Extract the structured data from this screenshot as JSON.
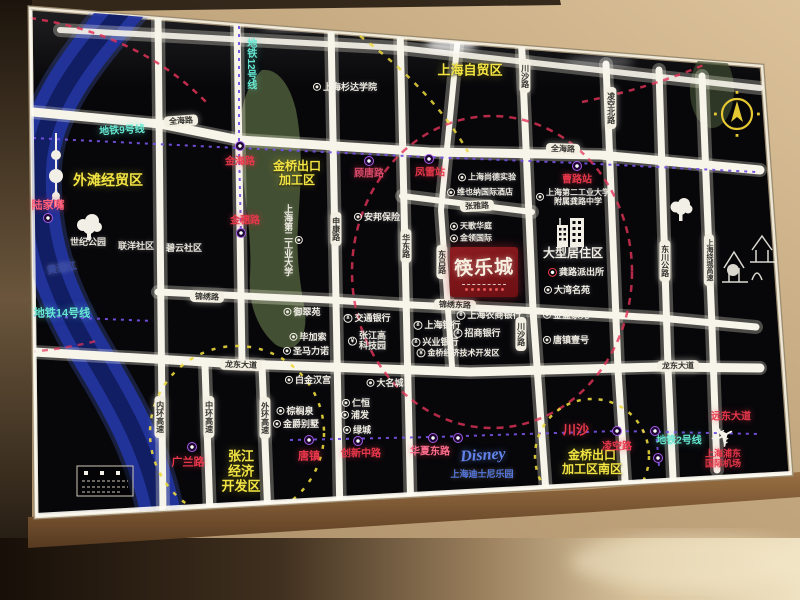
{
  "palette": {
    "panel_black": "#07070a",
    "road_white": "#f7f4ea",
    "river_blue": "#2238a8",
    "metro_dash_purple": "#7450e0",
    "metro_teal": "#66e8d2",
    "area_yellow": "#f2e443",
    "station_red": "#e8374a",
    "poi_white": "#efece2",
    "disney_blue": "#6383ea",
    "logo_red": "#7a161a",
    "green_zone": "#4e5c39",
    "wall_beige": "#c2a67e",
    "wood_brown": "#8a6038",
    "compass_yellow": "#e5c832"
  },
  "icons": {
    "airplane": "✈",
    "metro": "circle-M-badge",
    "poi": "ring-dot",
    "bank": "¥",
    "police": "red-ring-dot",
    "compass": "north-arrow",
    "tree": "tree-silhouette",
    "tower": "pearl-tower-silhouette",
    "temple": "old-town-lineart",
    "building": "residential-towers"
  },
  "map": {
    "logo": {
      "name": "筷乐城"
    },
    "labels": [
      {
        "n": "label-metro-line-12",
        "t": "地铁12号线",
        "x": 250,
        "y": 64,
        "k": "metroline",
        "v": 1,
        "s": 10
      },
      {
        "n": "label-metro-line-9",
        "t": "地铁9号线",
        "x": 122,
        "y": 131,
        "k": "metroline",
        "s": 10,
        "r": -3
      },
      {
        "n": "label-metro-line-14",
        "t": "地铁14号线",
        "x": 62,
        "y": 314,
        "k": "metroline",
        "s": 11
      },
      {
        "n": "label-metro-line-2",
        "t": "地铁2号线",
        "x": 679,
        "y": 441,
        "k": "metroline",
        "s": 10
      },
      {
        "n": "pill-quanhai-road-w",
        "t": "全海路",
        "x": 181,
        "y": 121,
        "k": "pill",
        "r": -4
      },
      {
        "n": "pill-quanhai-road-e",
        "t": "全海路",
        "x": 563,
        "y": 149,
        "k": "pill",
        "r": 2
      },
      {
        "n": "pill-jinxiu-road",
        "t": "锦绣路",
        "x": 207,
        "y": 297,
        "k": "pill",
        "r": 2
      },
      {
        "n": "pill-jinxiu-east-road",
        "t": "锦绣东路",
        "x": 455,
        "y": 305,
        "k": "pill",
        "r": 2
      },
      {
        "n": "pill-longdong-ave-w",
        "t": "龙东大道",
        "x": 241,
        "y": 365,
        "k": "pill",
        "r": 2
      },
      {
        "n": "pill-longdong-ave-e",
        "t": "龙东大道",
        "x": 678,
        "y": 366,
        "k": "pill",
        "r": -1
      },
      {
        "n": "pill-chuansha-road-n",
        "t": "川沙路",
        "x": 525,
        "y": 76,
        "k": "pill",
        "v": 1
      },
      {
        "n": "pill-lingkong-north-road",
        "t": "凌空北路",
        "x": 611,
        "y": 108,
        "k": "pill",
        "v": 1
      },
      {
        "n": "pill-shenkang-road",
        "t": "申康路",
        "x": 336,
        "y": 229,
        "k": "pill",
        "v": 1
      },
      {
        "n": "pill-huadong-road",
        "t": "华东路",
        "x": 406,
        "y": 246,
        "k": "pill",
        "v": 1
      },
      {
        "n": "pill-donglv-road",
        "t": "东吕路",
        "x": 442,
        "y": 262,
        "k": "pill",
        "v": 1
      },
      {
        "n": "pill-chuansha-road-s",
        "t": "川沙路",
        "x": 521,
        "y": 334,
        "k": "pill",
        "v": 1
      },
      {
        "n": "pill-dongchuan-highway",
        "t": "东川公路",
        "x": 665,
        "y": 261,
        "k": "pill",
        "v": 1
      },
      {
        "n": "pill-raocheng-expressway",
        "t": "上海绕城高速",
        "x": 709,
        "y": 260,
        "k": "pill",
        "v": 1,
        "s": 7
      },
      {
        "n": "pill-zhangya-road",
        "t": "张雅路",
        "x": 477,
        "y": 206,
        "k": "pill",
        "r": -3
      },
      {
        "n": "pill-neihuan-expressway",
        "t": "内环高速",
        "x": 160,
        "y": 417,
        "k": "pill",
        "v": 1
      },
      {
        "n": "pill-zhonghuan-expressway",
        "t": "中环高速",
        "x": 209,
        "y": 417,
        "k": "pill",
        "v": 1
      },
      {
        "n": "pill-waihuan-expressway",
        "t": "外环高速",
        "x": 265,
        "y": 418,
        "k": "pill",
        "v": 1
      },
      {
        "n": "label-waitan-trade-zone",
        "t": "外滩经贸区",
        "x": 108,
        "y": 180,
        "k": "area",
        "s": 14
      },
      {
        "n": "label-jinqiao-epz",
        "t": "金桥出口\n加工区",
        "x": 297,
        "y": 174,
        "k": "area",
        "s": 12
      },
      {
        "n": "label-shanghai-ftz",
        "t": "上海自贸区",
        "x": 470,
        "y": 71,
        "k": "area",
        "s": 13
      },
      {
        "n": "label-zhangjiang-zone",
        "t": "张江\n经济\n开发区",
        "x": 241,
        "y": 472,
        "k": "area",
        "s": 13
      },
      {
        "n": "label-jinqiao-epz-south",
        "t": "金桥出口\n加工区南区",
        "x": 592,
        "y": 463,
        "k": "area",
        "s": 12
      },
      {
        "n": "label-lujiazui",
        "t": "陆家嘴",
        "x": 48,
        "y": 206,
        "k": "station",
        "s": 11,
        "c": "#ff5d78"
      },
      {
        "n": "label-jinhai-road",
        "t": "金海路",
        "x": 240,
        "y": 162,
        "k": "station",
        "s": 10
      },
      {
        "n": "label-jinsui-road",
        "t": "金穗路",
        "x": 245,
        "y": 221,
        "k": "station",
        "s": 10
      },
      {
        "n": "label-gutang-road",
        "t": "顾唐路",
        "x": 369,
        "y": 174,
        "k": "station",
        "s": 10,
        "c": "#d84a6a"
      },
      {
        "n": "label-fenglei-station",
        "t": "凤雷站",
        "x": 430,
        "y": 173,
        "k": "station",
        "s": 10
      },
      {
        "n": "label-caolu-station",
        "t": "曹路站",
        "x": 577,
        "y": 180,
        "k": "station",
        "s": 10
      },
      {
        "n": "label-guanglan-road",
        "t": "广兰路",
        "x": 188,
        "y": 463,
        "k": "station",
        "s": 11
      },
      {
        "n": "label-tangzhen",
        "t": "唐镇",
        "x": 309,
        "y": 457,
        "k": "station",
        "s": 11
      },
      {
        "n": "label-chuangxin-middle-road",
        "t": "创新中路",
        "x": 361,
        "y": 454,
        "k": "station",
        "s": 10
      },
      {
        "n": "label-huaxia-east-road",
        "t": "华夏东路",
        "x": 430,
        "y": 452,
        "k": "station",
        "s": 10,
        "c": "#ff6e8e"
      },
      {
        "n": "label-chuansha",
        "t": "川沙",
        "x": 576,
        "y": 431,
        "k": "station",
        "s": 13
      },
      {
        "n": "label-lingkong-road",
        "t": "凌空路",
        "x": 617,
        "y": 447,
        "k": "station",
        "s": 10
      },
      {
        "n": "label-yuandong-ave",
        "t": "远东大道",
        "x": 731,
        "y": 417,
        "k": "station",
        "s": 10
      },
      {
        "n": "label-pudong-airport",
        "t": "上海浦东\n国际机场",
        "x": 723,
        "y": 459,
        "k": "station",
        "s": 9
      },
      {
        "n": "label-large-residential-zone",
        "t": "大型居住区",
        "x": 573,
        "y": 254,
        "k": "district",
        "s": 12
      },
      {
        "n": "label-century-park",
        "t": "世纪公园",
        "x": 88,
        "y": 242,
        "k": "note",
        "s": 9
      },
      {
        "n": "label-lianyang-community",
        "t": "联洋社区",
        "x": 136,
        "y": 246,
        "k": "note",
        "s": 9
      },
      {
        "n": "label-biyun-community",
        "t": "碧云社区",
        "x": 184,
        "y": 248,
        "k": "note",
        "s": 9
      },
      {
        "n": "label-huangpu-river",
        "t": "黄浦江",
        "x": 62,
        "y": 269,
        "k": "note",
        "s": 10,
        "c": "#35479e",
        "r": -10
      },
      {
        "n": "poi-sanda-university",
        "t": "上海杉达学院",
        "x": 345,
        "y": 87,
        "k": "poi",
        "s": 9
      },
      {
        "n": "poi-second-polytechnic-univ",
        "t": "上海第二工业大学",
        "x": 293,
        "y": 240,
        "k": "poi",
        "v": 1,
        "s": 9
      },
      {
        "n": "poi-anbang-insurance",
        "t": "安邦保险",
        "x": 377,
        "y": 217,
        "k": "poi",
        "s": 9
      },
      {
        "n": "poi-shangde-school",
        "t": "上海尚德实验",
        "x": 487,
        "y": 177,
        "k": "poi",
        "s": 8
      },
      {
        "n": "poi-vienna-hotel",
        "t": "维也纳国际酒店",
        "x": 480,
        "y": 192,
        "k": "poi",
        "s": 8
      },
      {
        "n": "poi-gonglu-middle-school",
        "t": "上海第二工业大学\n附属龚路中学",
        "x": 573,
        "y": 197,
        "k": "poi",
        "s": 8
      },
      {
        "n": "poi-tiange-huating",
        "t": "天歌华庭",
        "x": 471,
        "y": 226,
        "k": "poi",
        "s": 8
      },
      {
        "n": "poi-jinling-international",
        "t": "金领国际",
        "x": 471,
        "y": 238,
        "k": "poi",
        "s": 8
      },
      {
        "n": "poi-gonglu-police-station",
        "t": "龚路派出所",
        "x": 576,
        "y": 272,
        "k": "police",
        "s": 9
      },
      {
        "n": "poi-dawan-mingyuan",
        "t": "大湾名苑",
        "x": 567,
        "y": 290,
        "k": "poi",
        "s": 9
      },
      {
        "n": "poi-jinsheng-jiayuan",
        "t": "金盛家苑",
        "x": 566,
        "y": 315,
        "k": "poi",
        "s": 9
      },
      {
        "n": "poi-tangzhen-no1",
        "t": "唐镇壹号",
        "x": 566,
        "y": 340,
        "k": "poi",
        "s": 9
      },
      {
        "n": "poi-yucuiyuan",
        "t": "御翠苑",
        "x": 302,
        "y": 312,
        "k": "poi",
        "s": 9
      },
      {
        "n": "poi-bijiasuo",
        "t": "毕加索",
        "x": 308,
        "y": 337,
        "k": "poi",
        "s": 9
      },
      {
        "n": "poi-shengmalinuo",
        "t": "圣马力诺",
        "x": 306,
        "y": 351,
        "k": "poi",
        "s": 9
      },
      {
        "n": "poi-bank-of-communications",
        "t": "交通银行",
        "x": 367,
        "y": 318,
        "k": "bank",
        "s": 9
      },
      {
        "n": "poi-zhangjiang-hitech-park",
        "t": "张江高\n科技园",
        "x": 367,
        "y": 341,
        "k": "bank",
        "s": 9
      },
      {
        "n": "poi-shanghai-rural-bank",
        "t": "上海农商银行",
        "x": 489,
        "y": 315,
        "k": "bank",
        "s": 9
      },
      {
        "n": "poi-bank-of-shanghai",
        "t": "上海银行",
        "x": 437,
        "y": 325,
        "k": "bank",
        "s": 9
      },
      {
        "n": "poi-china-merchants-bank",
        "t": "招商银行",
        "x": 477,
        "y": 333,
        "k": "bank",
        "s": 9
      },
      {
        "n": "poi-industrial-bank",
        "t": "兴业银行",
        "x": 435,
        "y": 342,
        "k": "bank",
        "s": 9
      },
      {
        "n": "poi-jinqiao-tech-zone",
        "t": "金桥经济技术开发区",
        "x": 458,
        "y": 353,
        "k": "bank",
        "s": 8
      },
      {
        "n": "poi-buckingham-palace",
        "t": "白金汉宫",
        "x": 308,
        "y": 380,
        "k": "poi",
        "s": 9
      },
      {
        "n": "poi-damingcheng",
        "t": "大名城",
        "x": 385,
        "y": 383,
        "k": "poi",
        "s": 9
      },
      {
        "n": "poi-renheng",
        "t": "仁恒",
        "x": 356,
        "y": 403,
        "k": "poi",
        "s": 9
      },
      {
        "n": "poi-pufa",
        "t": "浦发",
        "x": 355,
        "y": 415,
        "k": "poi",
        "s": 9
      },
      {
        "n": "poi-lvcheng",
        "t": "绿城",
        "x": 357,
        "y": 430,
        "k": "poi",
        "s": 9
      },
      {
        "n": "poi-zonglvquan",
        "t": "棕榈泉",
        "x": 295,
        "y": 411,
        "k": "poi",
        "s": 9
      },
      {
        "n": "poi-jinjue-villa",
        "t": "金爵别墅",
        "x": 296,
        "y": 424,
        "k": "poi",
        "s": 9
      },
      {
        "n": "label-disney-logo",
        "t": "Disney",
        "x": 483,
        "y": 456,
        "k": "disney",
        "s": 16,
        "r": -4
      },
      {
        "n": "label-disney-resort",
        "t": "上海迪士尼乐园",
        "x": 482,
        "y": 474,
        "k": "note",
        "s": 9,
        "c": "#5577e0"
      },
      {
        "n": "metro-icon-lujiazui",
        "t": "",
        "x": 48,
        "y": 218,
        "k": "micon"
      },
      {
        "n": "metro-icon-jinhai",
        "t": "",
        "x": 240,
        "y": 146,
        "k": "micon"
      },
      {
        "n": "metro-icon-jinsui",
        "t": "",
        "x": 241,
        "y": 233,
        "k": "micon"
      },
      {
        "n": "metro-icon-gutang",
        "t": "",
        "x": 369,
        "y": 161,
        "k": "micon"
      },
      {
        "n": "metro-icon-fenglei",
        "t": "",
        "x": 429,
        "y": 159,
        "k": "micon"
      },
      {
        "n": "metro-icon-caolu",
        "t": "",
        "x": 577,
        "y": 166,
        "k": "micon"
      },
      {
        "n": "metro-icon-guanglan",
        "t": "",
        "x": 192,
        "y": 447,
        "k": "micon"
      },
      {
        "n": "metro-icon-tangzhen",
        "t": "",
        "x": 309,
        "y": 440,
        "k": "micon"
      },
      {
        "n": "metro-icon-chuangxin",
        "t": "",
        "x": 358,
        "y": 441,
        "k": "micon"
      },
      {
        "n": "metro-icon-huaxia-w",
        "t": "",
        "x": 433,
        "y": 438,
        "k": "micon"
      },
      {
        "n": "metro-icon-huaxia-e",
        "t": "",
        "x": 458,
        "y": 438,
        "k": "micon"
      },
      {
        "n": "metro-icon-lingkong",
        "t": "",
        "x": 617,
        "y": 431,
        "k": "micon"
      },
      {
        "n": "metro-icon-yuandong-n",
        "t": "",
        "x": 655,
        "y": 431,
        "k": "micon"
      },
      {
        "n": "metro-icon-yuandong-s",
        "t": "",
        "x": 658,
        "y": 458,
        "k": "micon"
      }
    ]
  }
}
